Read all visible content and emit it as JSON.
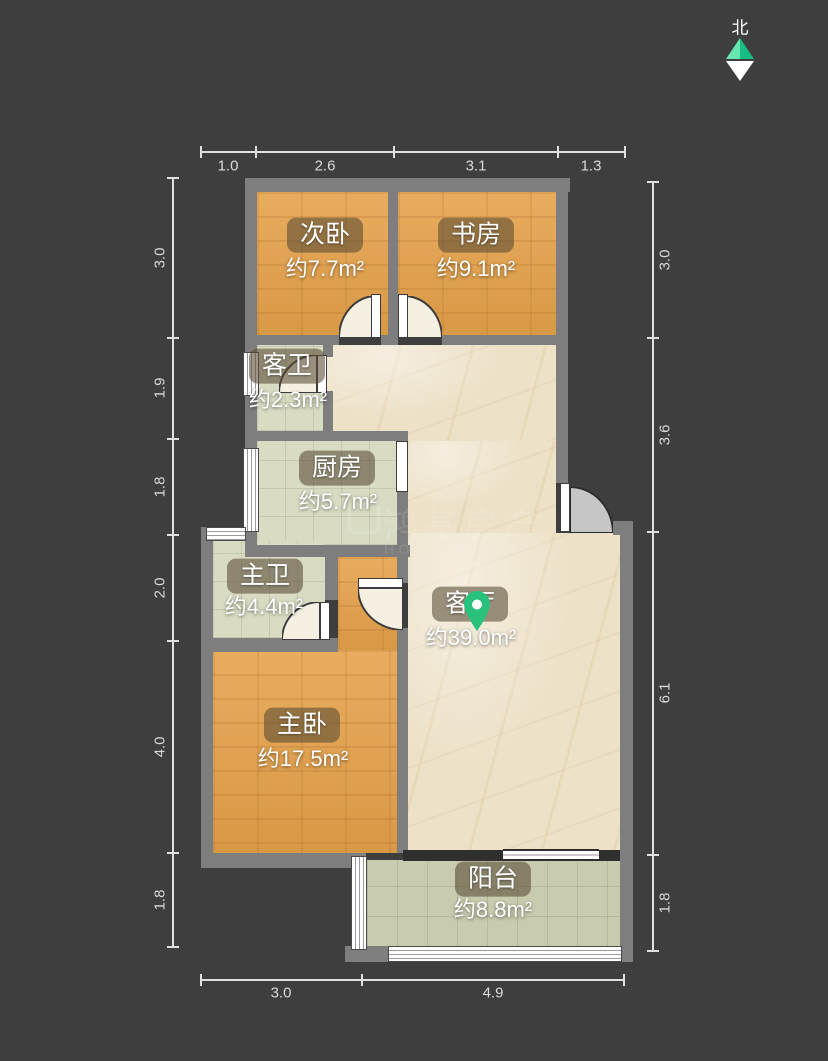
{
  "compass": {
    "north_label": "北"
  },
  "watermark": {
    "cn": "鸿基房产",
    "en": "HONG JI ESTATE"
  },
  "rooms": [
    {
      "key": "ciwo",
      "name": "次卧",
      "area": "约7.7m²"
    },
    {
      "key": "shufang",
      "name": "书房",
      "area": "约9.1m²"
    },
    {
      "key": "kewei",
      "name": "客卫",
      "area": "约2.3m²"
    },
    {
      "key": "chufang",
      "name": "厨房",
      "area": "约5.7m²"
    },
    {
      "key": "zhuwei",
      "name": "主卫",
      "area": "约4.4m²"
    },
    {
      "key": "keting",
      "name": "客厅",
      "area": "约39.0m²"
    },
    {
      "key": "zhuwo",
      "name": "主卧",
      "area": "约17.5m²"
    },
    {
      "key": "yangtai",
      "name": "阳台",
      "area": "约8.8m²"
    }
  ],
  "dims": {
    "top": [
      "1.0",
      "2.6",
      "3.1",
      "1.3"
    ],
    "left": [
      "3.0",
      "1.9",
      "1.8",
      "2.0",
      "4.0",
      "1.8"
    ],
    "right": [
      "3.0",
      "3.6",
      "6.1",
      "1.8"
    ],
    "bottom": [
      "3.0",
      "4.9"
    ]
  },
  "colors": {
    "background": "#3e3e3e",
    "wall": "#7e7e7e",
    "wood_floor": "#dfa253",
    "tile_floor": "#d9dcc3",
    "balcony_floor": "#c9cbaf",
    "marble_floor": "#ede1c7",
    "pin_green": "#29c27d",
    "compass_green": "#17bd82"
  }
}
